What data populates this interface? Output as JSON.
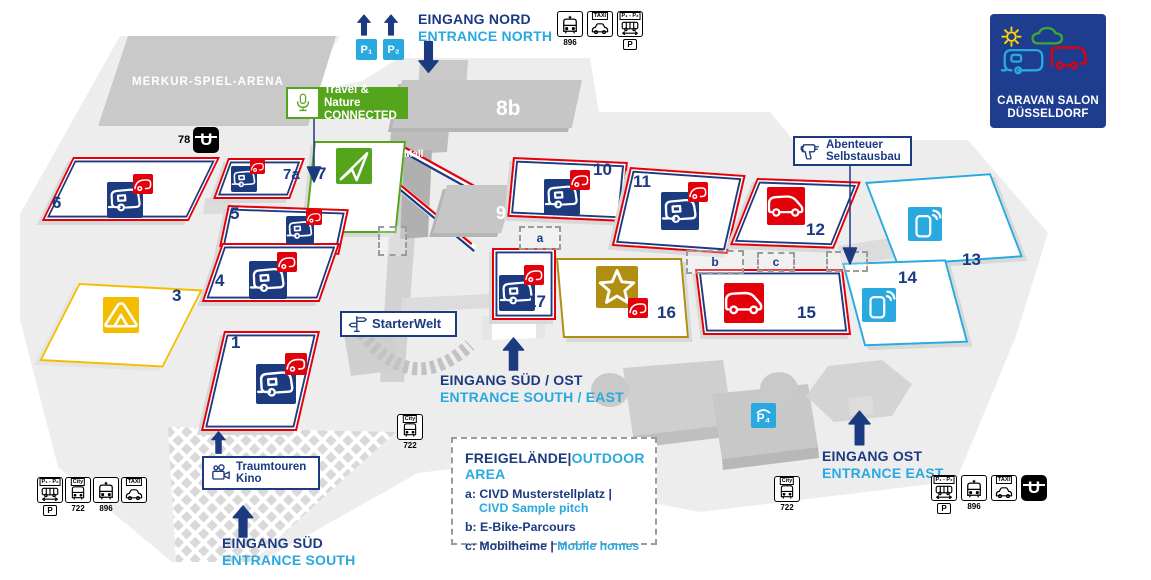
{
  "map": {
    "arena": "MERKUR-SPIEL-ARENA",
    "mall": "Mall"
  },
  "logo": {
    "line1": "CARAVAN SALON",
    "line2": "DÜSSELDORF"
  },
  "entrances": {
    "north_de": "EINGANG NORD",
    "north_en": "ENTRANCE NORTH",
    "south_de": "EINGANG SÜD",
    "south_en": "ENTRANCE SOUTH",
    "southeast_de": "EINGANG SÜD / OST",
    "southeast_en": "ENTRANCE SOUTH / EAST",
    "east_de": "EINGANG OST",
    "east_en": "ENTRANCE EAST"
  },
  "halls": [
    {
      "label": "6"
    },
    {
      "label": "7a"
    },
    {
      "label": "7"
    },
    {
      "label": "8b"
    },
    {
      "label": "9"
    },
    {
      "label": "5"
    },
    {
      "label": "4"
    },
    {
      "label": "3"
    },
    {
      "label": "1"
    },
    {
      "label": "10"
    },
    {
      "label": "11"
    },
    {
      "label": "12"
    },
    {
      "label": "13"
    },
    {
      "label": "14"
    },
    {
      "label": "15"
    },
    {
      "label": "16"
    },
    {
      "label": "17"
    }
  ],
  "badges": {
    "travel_nature_1": "Travel & Nature",
    "travel_nature_2": "CONNECTED",
    "abenteuer_1": "Abenteuer",
    "abenteuer_2": "Selbstausbau",
    "starterwelt": "StarterWelt",
    "kino_1": "Traumtouren",
    "kino_2": "Kino"
  },
  "legend": {
    "title_de": "FREIGELÄNDE",
    "sep": "|",
    "title_en": "OUTDOOR AREA",
    "a_key": "a:",
    "a_de": "CIVD Musterstellplatz |",
    "a_en": "CIVD Sample pitch",
    "b_key": "b:",
    "b_de": "E-Bike-Parcours",
    "c_key": "c:",
    "c_de": "Mobilheime |",
    "c_en": "Mobile homes"
  },
  "markers": {
    "a": "a",
    "b": "b",
    "c": "c"
  },
  "transit": {
    "bus_896": "896",
    "bus_722": "722",
    "taxi": "TAXI",
    "city": "City",
    "p": "P",
    "p1": "P₁",
    "p2": "P₂",
    "p4": "P₄",
    "u": "U",
    "u_line": "78",
    "shuttle": "P₁ - P₂"
  },
  "colors": {
    "navy": "#1c3a80",
    "light_blue": "#29a9e0",
    "red": "#e3000b",
    "green": "#55a51c",
    "gold": "#af8e12",
    "yellow": "#f5bd00"
  }
}
